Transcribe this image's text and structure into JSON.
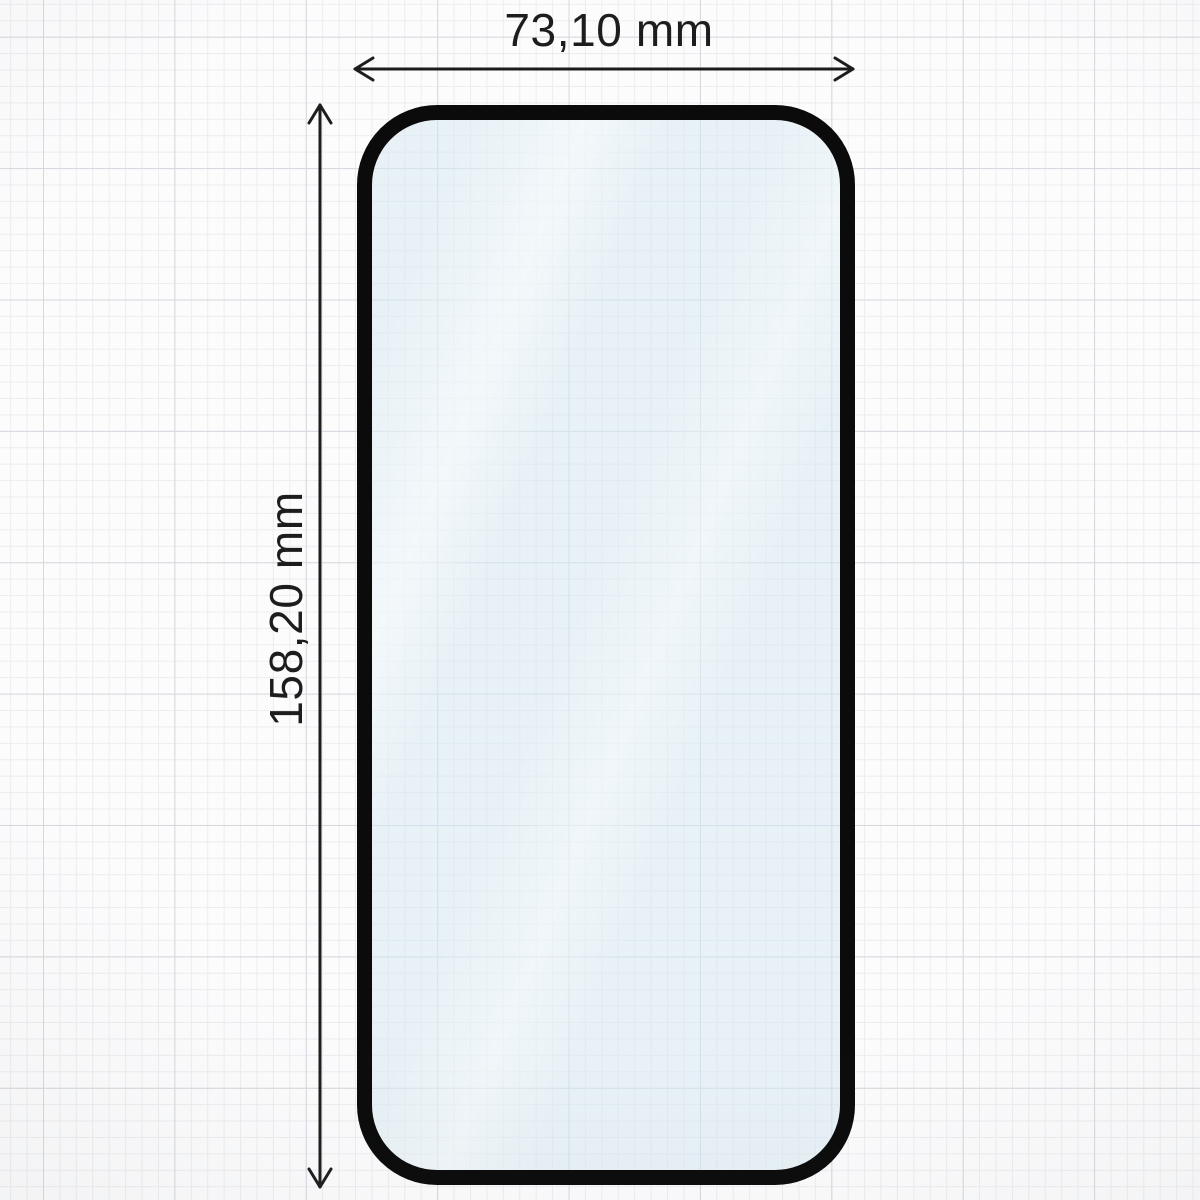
{
  "diagram": {
    "type": "screen-protector-dimension-drawing",
    "width_label": "73,10 mm",
    "height_label": "158,20 mm",
    "colors": {
      "bg": "#fcfcfd",
      "grid-minor": "#ededf0",
      "grid-major": "#d5d8dd",
      "outline": "#0b0b0b",
      "glass": "rgba(213,232,241,0.55)",
      "dimension": "#1d1d1d"
    }
  }
}
